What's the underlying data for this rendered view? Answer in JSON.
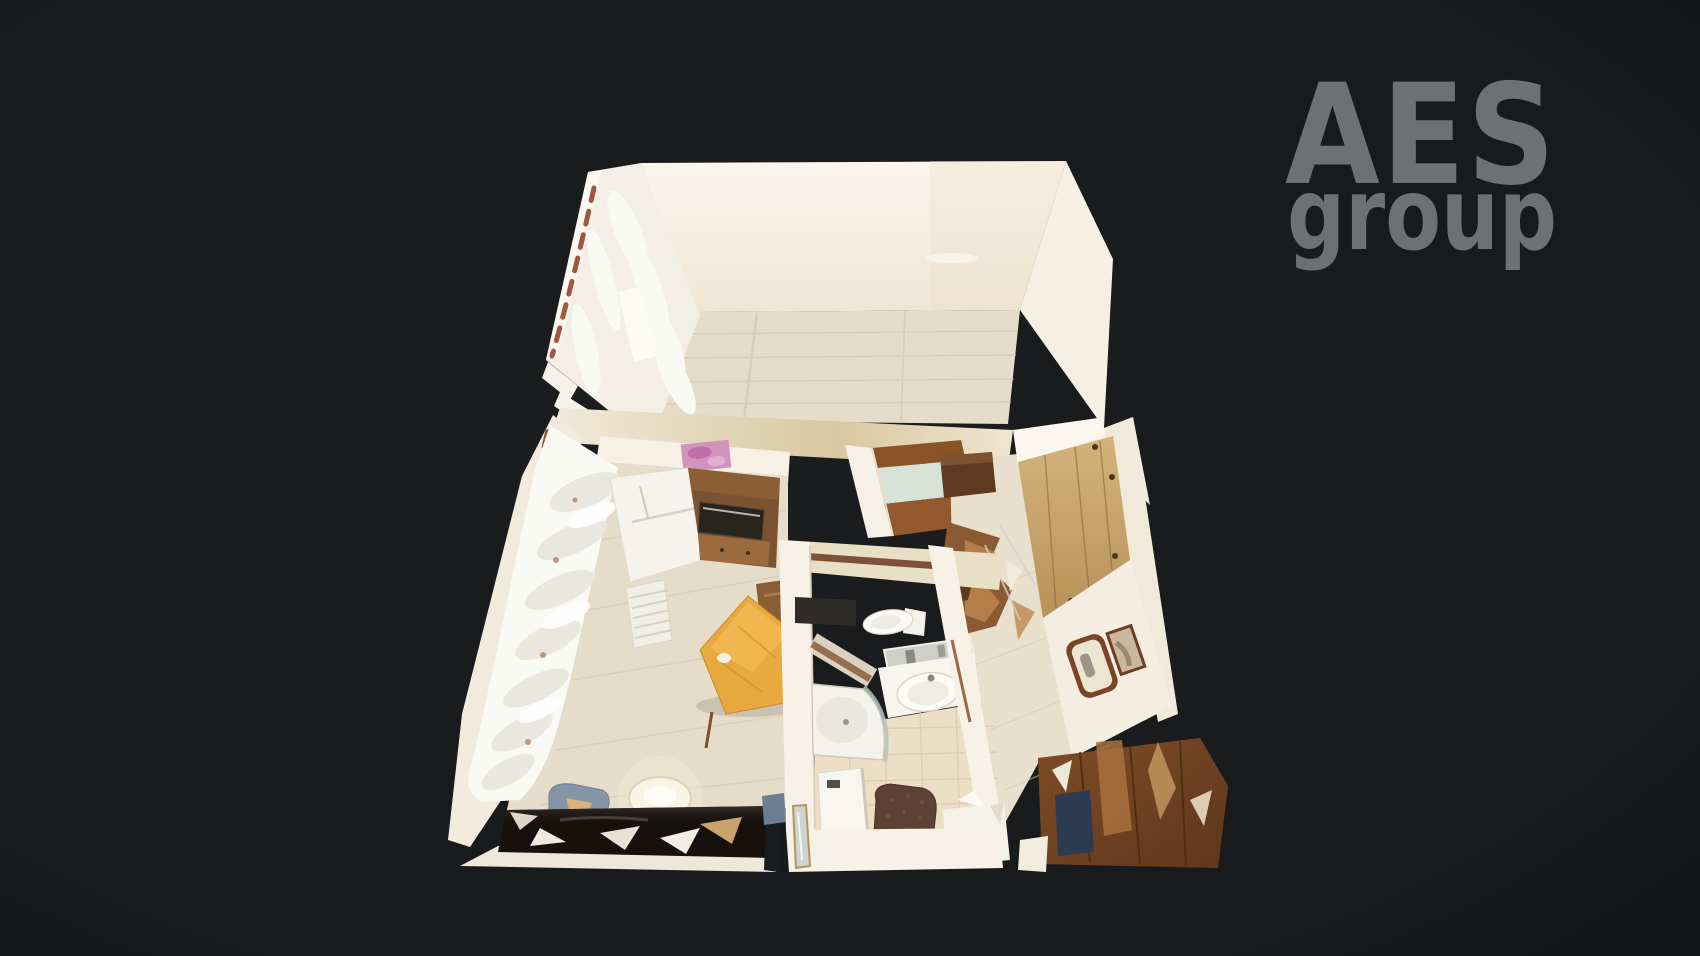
{
  "watermark": {
    "brand": "AES",
    "brand_sub": "group",
    "color": "#6e7072"
  },
  "palette": {
    "background": "#1a1c1e",
    "wall": "#f7f1e7",
    "wall_bright": "#fbf7ef",
    "wall_shadow": "#eadfcc",
    "gold_band": "#d9c8a2",
    "wood_floor": "#e5dcca",
    "wood_floor_warm": "#e9dfcd",
    "tile_floor": "#ecdfc6",
    "curtain": "#fafaf5",
    "rod_red": "#8e3c1f",
    "poster_pink": "#cf93bc",
    "fridge_white": "#f6f3ec",
    "cabinet_walnut": "#7c5331",
    "cabinet_light": "#9c6b3d",
    "microwave_dark": "#28251f",
    "desk_orange": "#e8a93e",
    "chair_wood": "#8a5e35",
    "dark_desk": "#16110d",
    "chair_blue": "#8595a8",
    "oak": "#c9a76b",
    "dark_wood": "#6e4426",
    "mat_navy": "#2c3a52",
    "shower_glass": "#b5c4ba",
    "tile_stripe": "#7d5138",
    "shower_tray": "#f4f2ec",
    "sink_white": "#fdfcf9"
  }
}
